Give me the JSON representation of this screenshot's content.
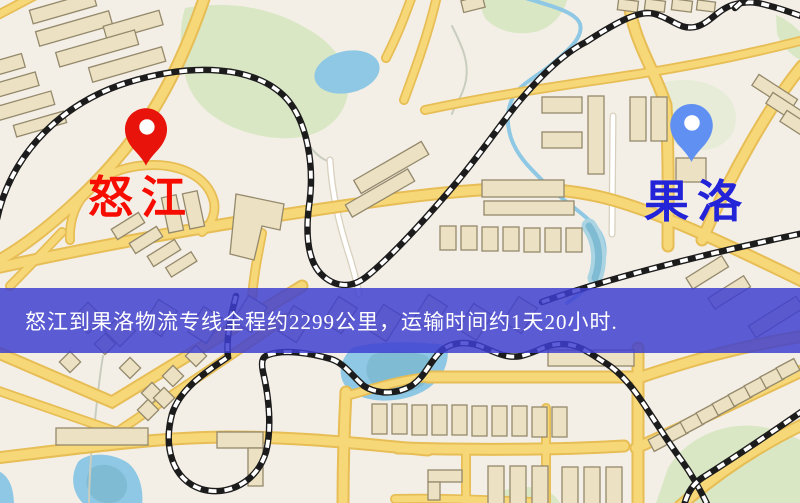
{
  "banner": {
    "text": "怒江到果洛物流专线全程约2299公里，运输时间约1天20小时.",
    "background": "rgba(62,62,208,0.84)",
    "text_color": "#ffffff"
  },
  "markers": {
    "origin": {
      "label": "怒江",
      "pin_color": "#e8130a",
      "pin_hole_color": "#ffffff",
      "label_color": "#f60d00",
      "icon": "map-pin"
    },
    "destination": {
      "label": "果洛",
      "pin_color": "#6090f2",
      "pin_hole_color": "#ffffff",
      "label_color": "#2323d8",
      "icon": "map-pin"
    }
  },
  "map": {
    "background": "#f3efe6",
    "road_color": "#f7d878",
    "road_casing": "#e7bd55",
    "water": "#8fc8e4",
    "water_deep": "#7fbcd4",
    "park": "#d9e7c5",
    "park_pale": "#e6ecd8",
    "building": "#ece2c3",
    "building_outline": "#95896c",
    "railway": "#1c1c1c"
  }
}
